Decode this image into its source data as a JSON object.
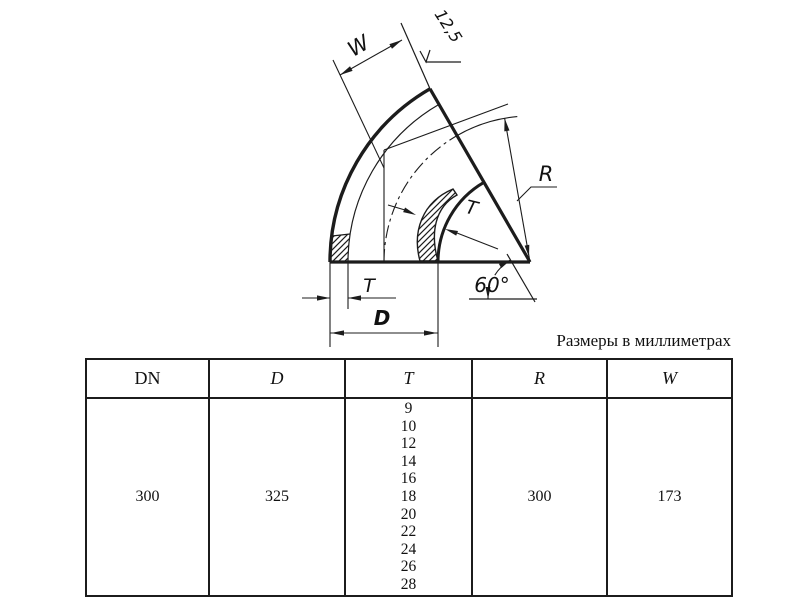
{
  "caption": "Размеры в миллиметрах",
  "drawing": {
    "labels": {
      "width": "W",
      "roughness": "12,5",
      "radius": "R",
      "wall_mid": "T",
      "angle": "60°",
      "wall_bottom": "T",
      "diameter": "D"
    }
  },
  "table": {
    "headers": [
      "DN",
      "D",
      "T",
      "R",
      "W"
    ],
    "row": {
      "dn": "300",
      "d": "325",
      "t": [
        "9",
        "10",
        "12",
        "14",
        "16",
        "18",
        "20",
        "22",
        "24",
        "26",
        "28"
      ],
      "r": "300",
      "w": "173"
    }
  },
  "colors": {
    "line": "#1c1c1c",
    "background": "#ffffff"
  }
}
